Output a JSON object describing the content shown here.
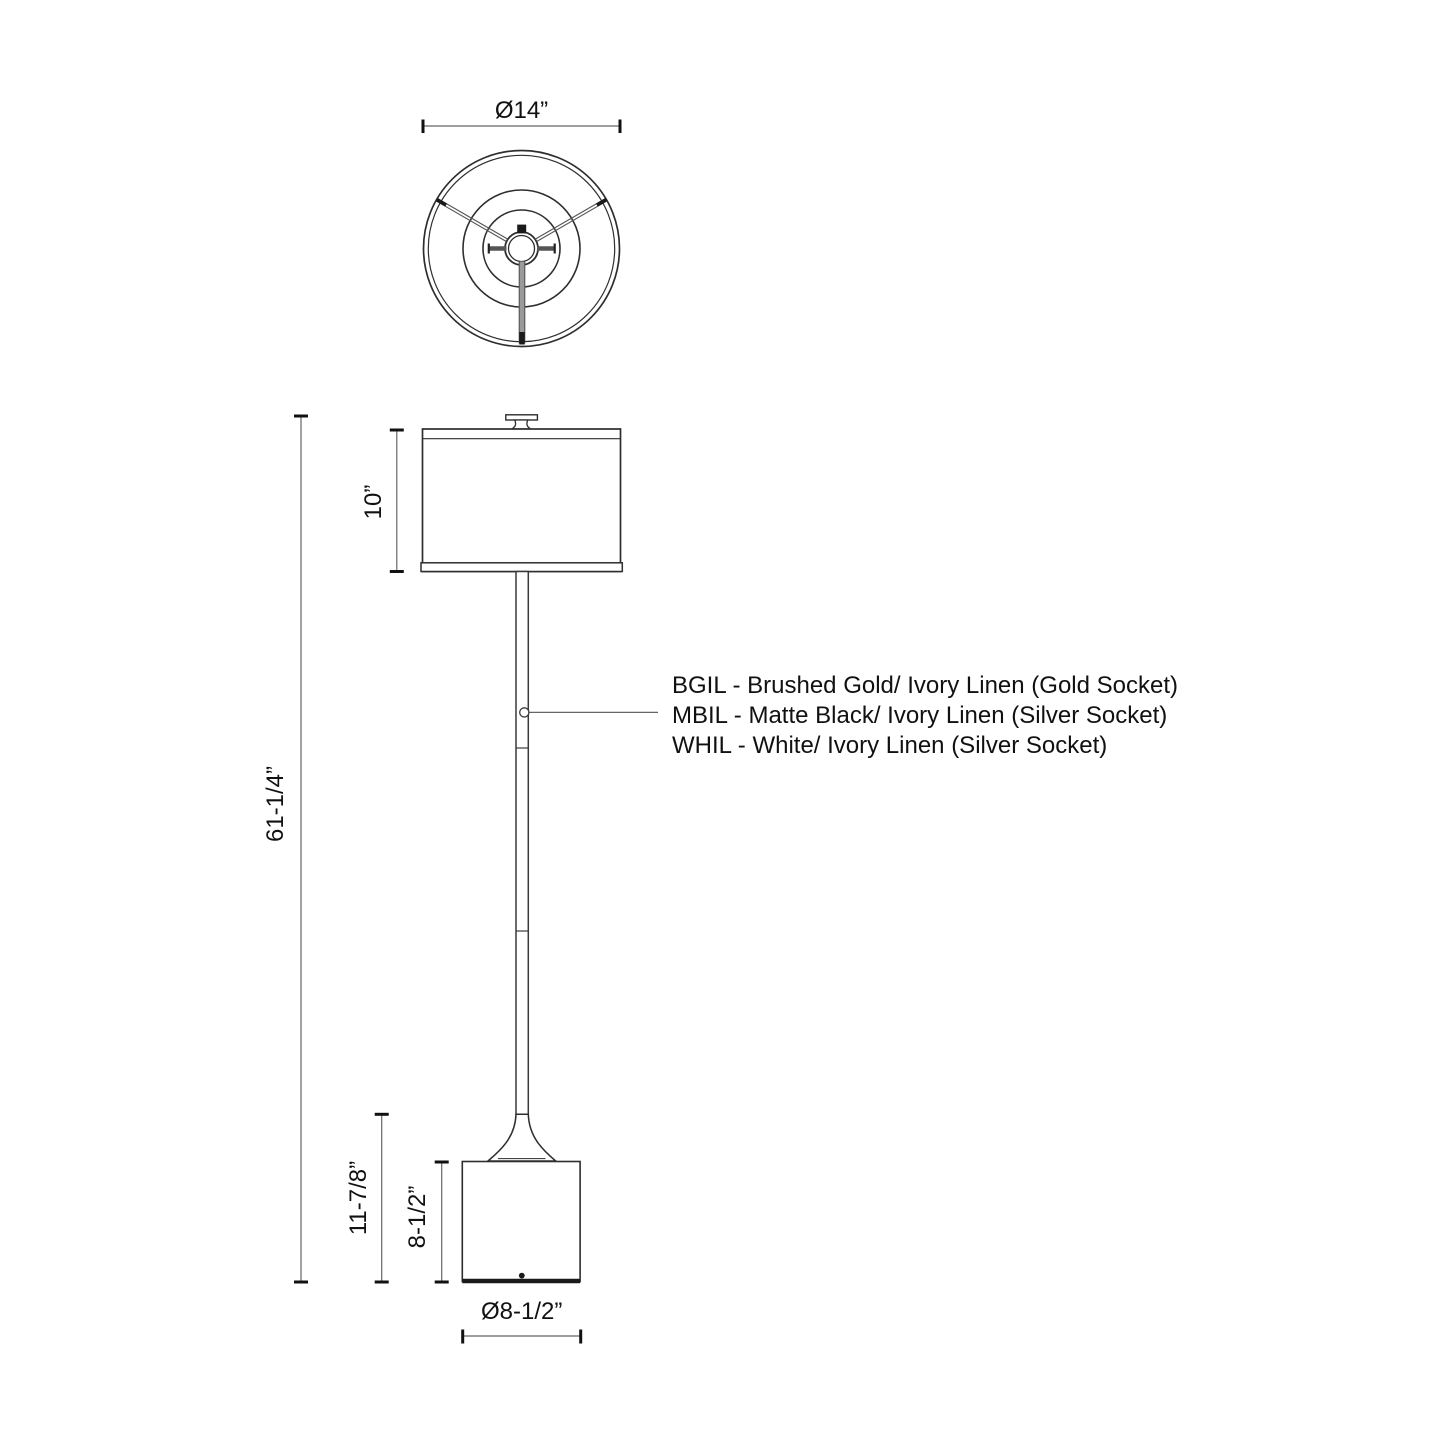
{
  "diagram": {
    "views": {
      "top": {
        "shade_diameter": "Ø14”"
      },
      "side": {
        "shade_height": "10”",
        "total_height": "61-1/4”",
        "base_assembly_height": "11-7/8”",
        "base_height": "8-1/2”",
        "base_diameter": "Ø8-1/2”"
      }
    },
    "finish_options": [
      "BGIL - Brushed Gold/ Ivory Linen (Gold Socket)",
      "MBIL - Matte Black/ Ivory Linen (Silver Socket)",
      "WHIL - White/ Ivory Linen (Silver Socket)"
    ],
    "colors": {
      "outline": "#2e2e2e",
      "dimension_line": "#666666",
      "tick": "#111111",
      "text": "#111111",
      "background": "#ffffff"
    }
  }
}
